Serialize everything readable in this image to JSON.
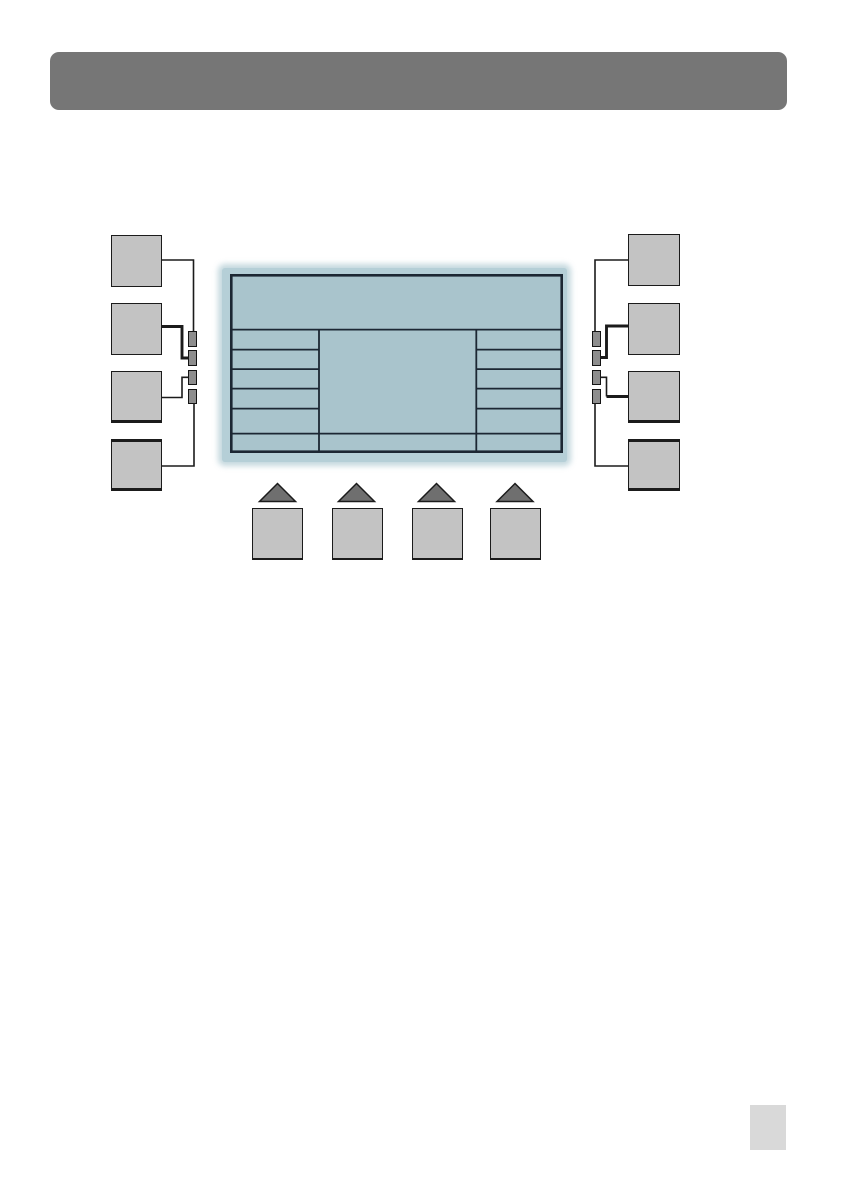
{
  "document": {
    "kind": "manual-page-diagram",
    "header_bar_text": "",
    "page_marker_text": ""
  },
  "colors": {
    "page_bg": "#ffffff",
    "header_bar": "#767676",
    "callout_fill": "#c3c3c3",
    "callout_border": "#1b1b1b",
    "leader_line": "#1b1b1b",
    "softkey_fill": "#8d8d8d",
    "softkey_border": "#141414",
    "screen_fill": "#a9c4cc",
    "bezel_fill": "#b5cfd7",
    "screen_line": "#1c2733",
    "triangle_fill": "#6f6f6f",
    "button_fill": "#c3c3c3",
    "page_marker": "#d9d9d9"
  },
  "figure": {
    "left_callout_count": 4,
    "right_callout_count": 4,
    "left_softkey_count": 4,
    "right_softkey_count": 4,
    "bottom_button_count": 4,
    "screen": {
      "has_header_band": true,
      "left_column_rows": 5,
      "right_column_rows": 5,
      "has_full_width_bottom_row": true,
      "column_count": 3
    }
  }
}
